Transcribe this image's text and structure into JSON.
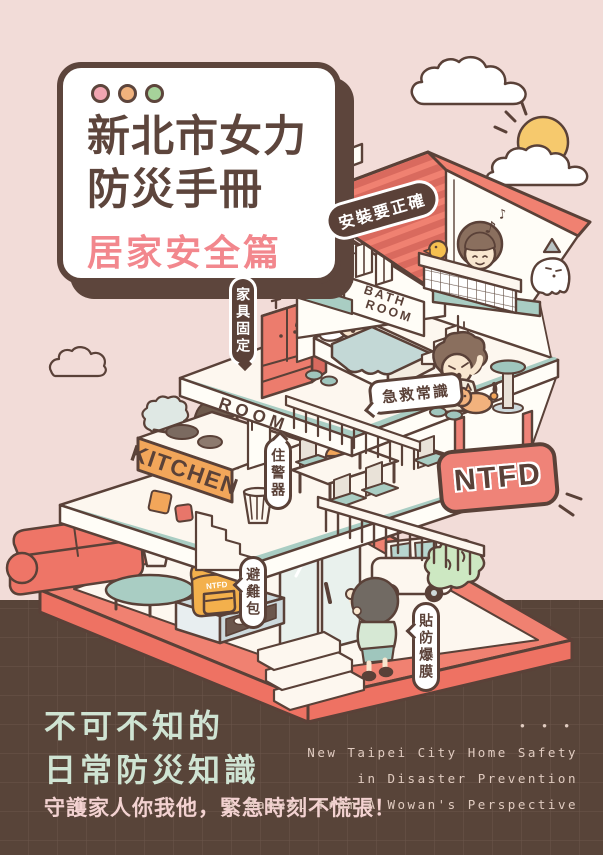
{
  "poster": {
    "title_card": {
      "title_line1": "新北市女力",
      "title_line2": "防災手冊",
      "subtitle": "居家安全篇"
    },
    "labels": {
      "install_correctly": "安裝要正確",
      "secure_furniture": "家具固定",
      "first_aid": "急救常識",
      "smoke_alarm": "住警器",
      "go_bag": "避難包",
      "blast_film": "貼防爆膜",
      "kitchen_sign": "KITCHEN",
      "bath_sign_line1": "BATH",
      "bath_sign_line2": "ROOM",
      "room_sign": "ROOM",
      "ntfd_sign": "NTFD",
      "backpack_tag": "NTFD",
      "music_note": "♪"
    },
    "footer": {
      "headline_line1": "不可不知的",
      "headline_line2": "日常防災知識",
      "tagline": "守護家人你我他，緊急時刻不慌張！",
      "dots": "•  •  •",
      "english_line1": "New Taipei City Home Safety",
      "english_line2": "in Disaster Prevention",
      "english_line3": "A Manual from A Wowan's Perspective"
    },
    "colors": {
      "background_pink": "#f2dcd8",
      "background_brown": "#584439",
      "outline_brown": "#5a4138",
      "roof_coral": "#f08171",
      "accent_teal": "#a9cdc3",
      "banner_orange": "#f2a65a",
      "sign_red": "#ef8378",
      "mint_text": "#cfe4d3",
      "pink_text": "#f3d2d1",
      "dot_pink": "#f2a5b1",
      "dot_orange": "#f0b27d",
      "dot_green": "#a6d29a"
    }
  }
}
